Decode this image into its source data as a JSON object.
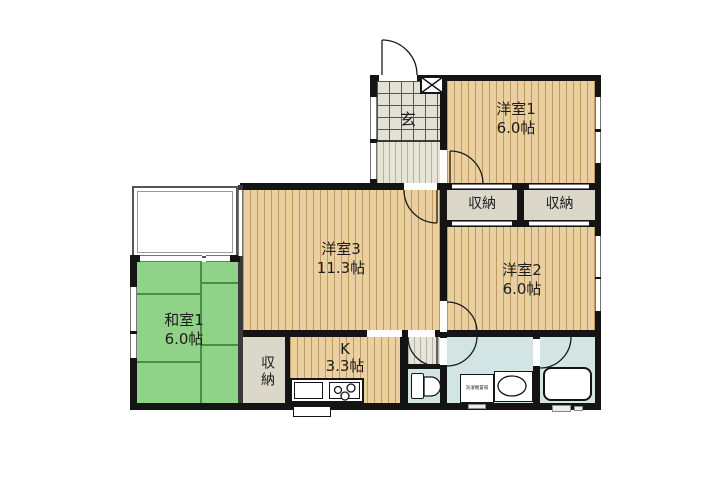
{
  "rooms": {
    "yoshitsu1": {
      "name": "洋室1",
      "size": "6.0帖"
    },
    "yoshitsu2": {
      "name": "洋室2",
      "size": "6.0帖"
    },
    "yoshitsu3": {
      "name": "洋室3",
      "size": "11.3帖"
    },
    "washitsu1": {
      "name": "和室1",
      "size": "6.0帖"
    },
    "kitchen": {
      "name": "K",
      "size": "3.3帖"
    },
    "genkan": {
      "name": "玄"
    },
    "closet_top_left": {
      "name": "収納"
    },
    "closet_top_right": {
      "name": "収納"
    },
    "closet_bottom": {
      "name": "収納"
    },
    "laundry": {
      "label": "洗濯機置場"
    }
  },
  "colors": {
    "wall": "#141414",
    "wood": "#ead0a0",
    "woodStripe": "#bf9a5e",
    "tatami": "#90d287",
    "tatamiLine": "#4b8c49",
    "water": "#d2e5e4",
    "closet": "#dbd8ca",
    "tile": "#e3e0d4",
    "hall": "#e6e3d7"
  }
}
